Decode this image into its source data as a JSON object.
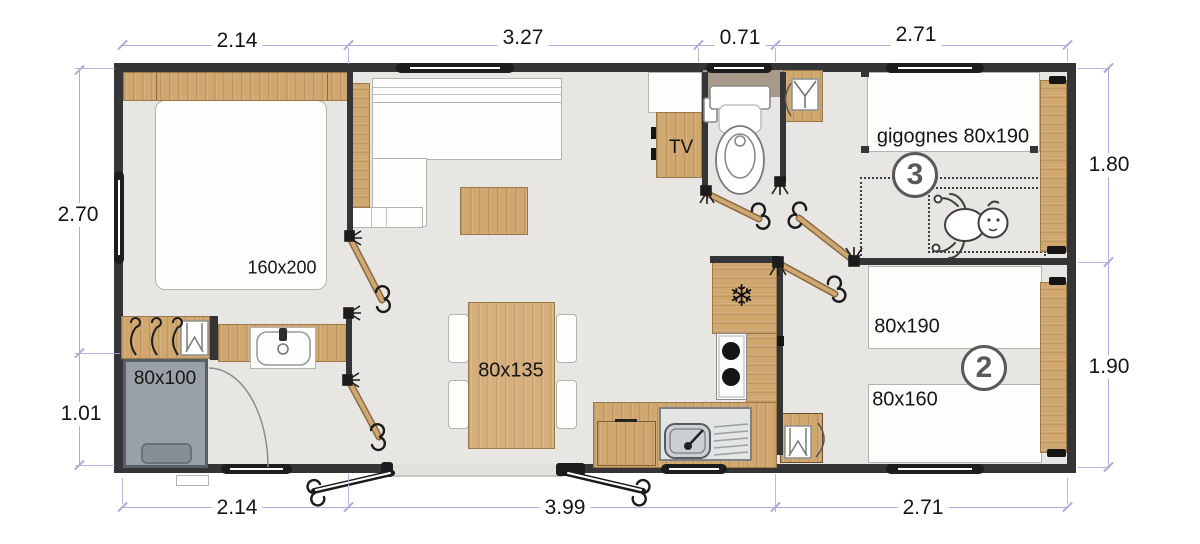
{
  "title": "Mobile home floor plan",
  "dimensions": {
    "top": [
      "2.14",
      "3.27",
      "0.71",
      "2.71"
    ],
    "bottom": [
      "2.14",
      "3.99",
      "2.71"
    ],
    "left": [
      "2.70",
      "1.01"
    ],
    "right": [
      "1.80",
      "1.90"
    ]
  },
  "labels": {
    "master_bed": "160x200",
    "shower": "80x100",
    "dining_table": "80x135",
    "tv_unit": "TV",
    "nesting_beds": "gigognes 80x190",
    "single_bed": "80x190",
    "small_bed": "80x160"
  },
  "room_numbers": {
    "bedroom3": "3",
    "bedroom2": "2"
  },
  "icons": {
    "fridge_snowflake": "❄"
  },
  "colors": {
    "wall": "#353537",
    "floor": "#e8e6e2",
    "wood": "#cfa76f",
    "shower": "#9aa0a7",
    "taupe": "#a89a8b",
    "dim": "#b1a8dc",
    "circle": "#58595b",
    "terrace": "#e2e1dd"
  }
}
